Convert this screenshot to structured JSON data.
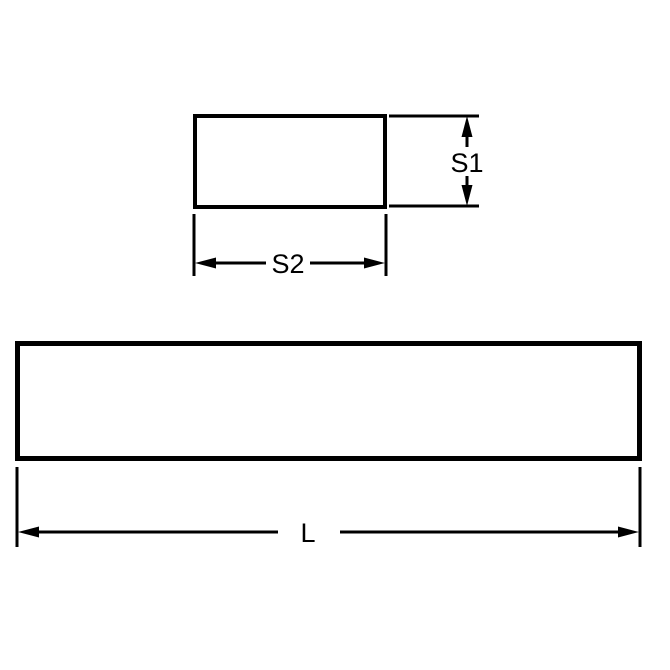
{
  "diagram": {
    "kind": "technical-dimension-drawing",
    "background_color": "#ffffff",
    "line_color": "#000000",
    "views": {
      "cross_section": {
        "name": "rectangular cross-section",
        "height_label": "S1",
        "width_label": "S2"
      },
      "side_view": {
        "name": "bar side length view",
        "length_label": "L"
      }
    }
  }
}
